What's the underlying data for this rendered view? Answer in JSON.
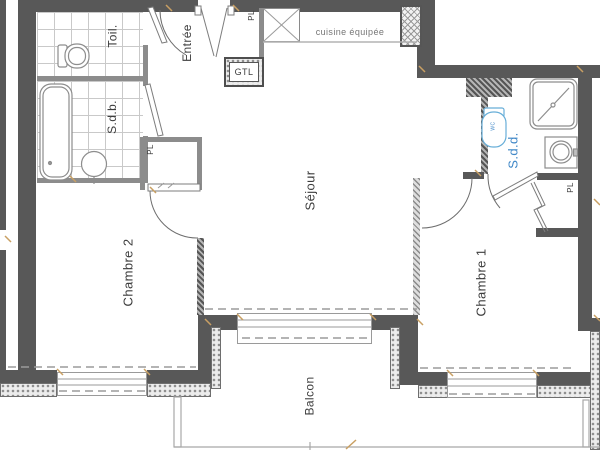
{
  "plan": {
    "rooms": {
      "entree": "Entrée",
      "toilettes": "Toil.",
      "salle_de_bain": "S.d.b.",
      "sejour": "Séjour",
      "chambre2": "Chambre 2",
      "chambre1": "Chambre 1",
      "salle_de_douche": "S.d.d.",
      "balcon": "Balcon",
      "cuisine": "cuisine équipée"
    },
    "labels": {
      "gtl": "GTL",
      "placard": "PL",
      "wc": "WC"
    },
    "colors": {
      "wall": "#585858",
      "partition": "#8c8c8c",
      "accent_blue": "#3f87c7",
      "wc_blue": "#67aed8",
      "joint_tan": "#c9a063",
      "text": "#3d3d3d"
    }
  }
}
